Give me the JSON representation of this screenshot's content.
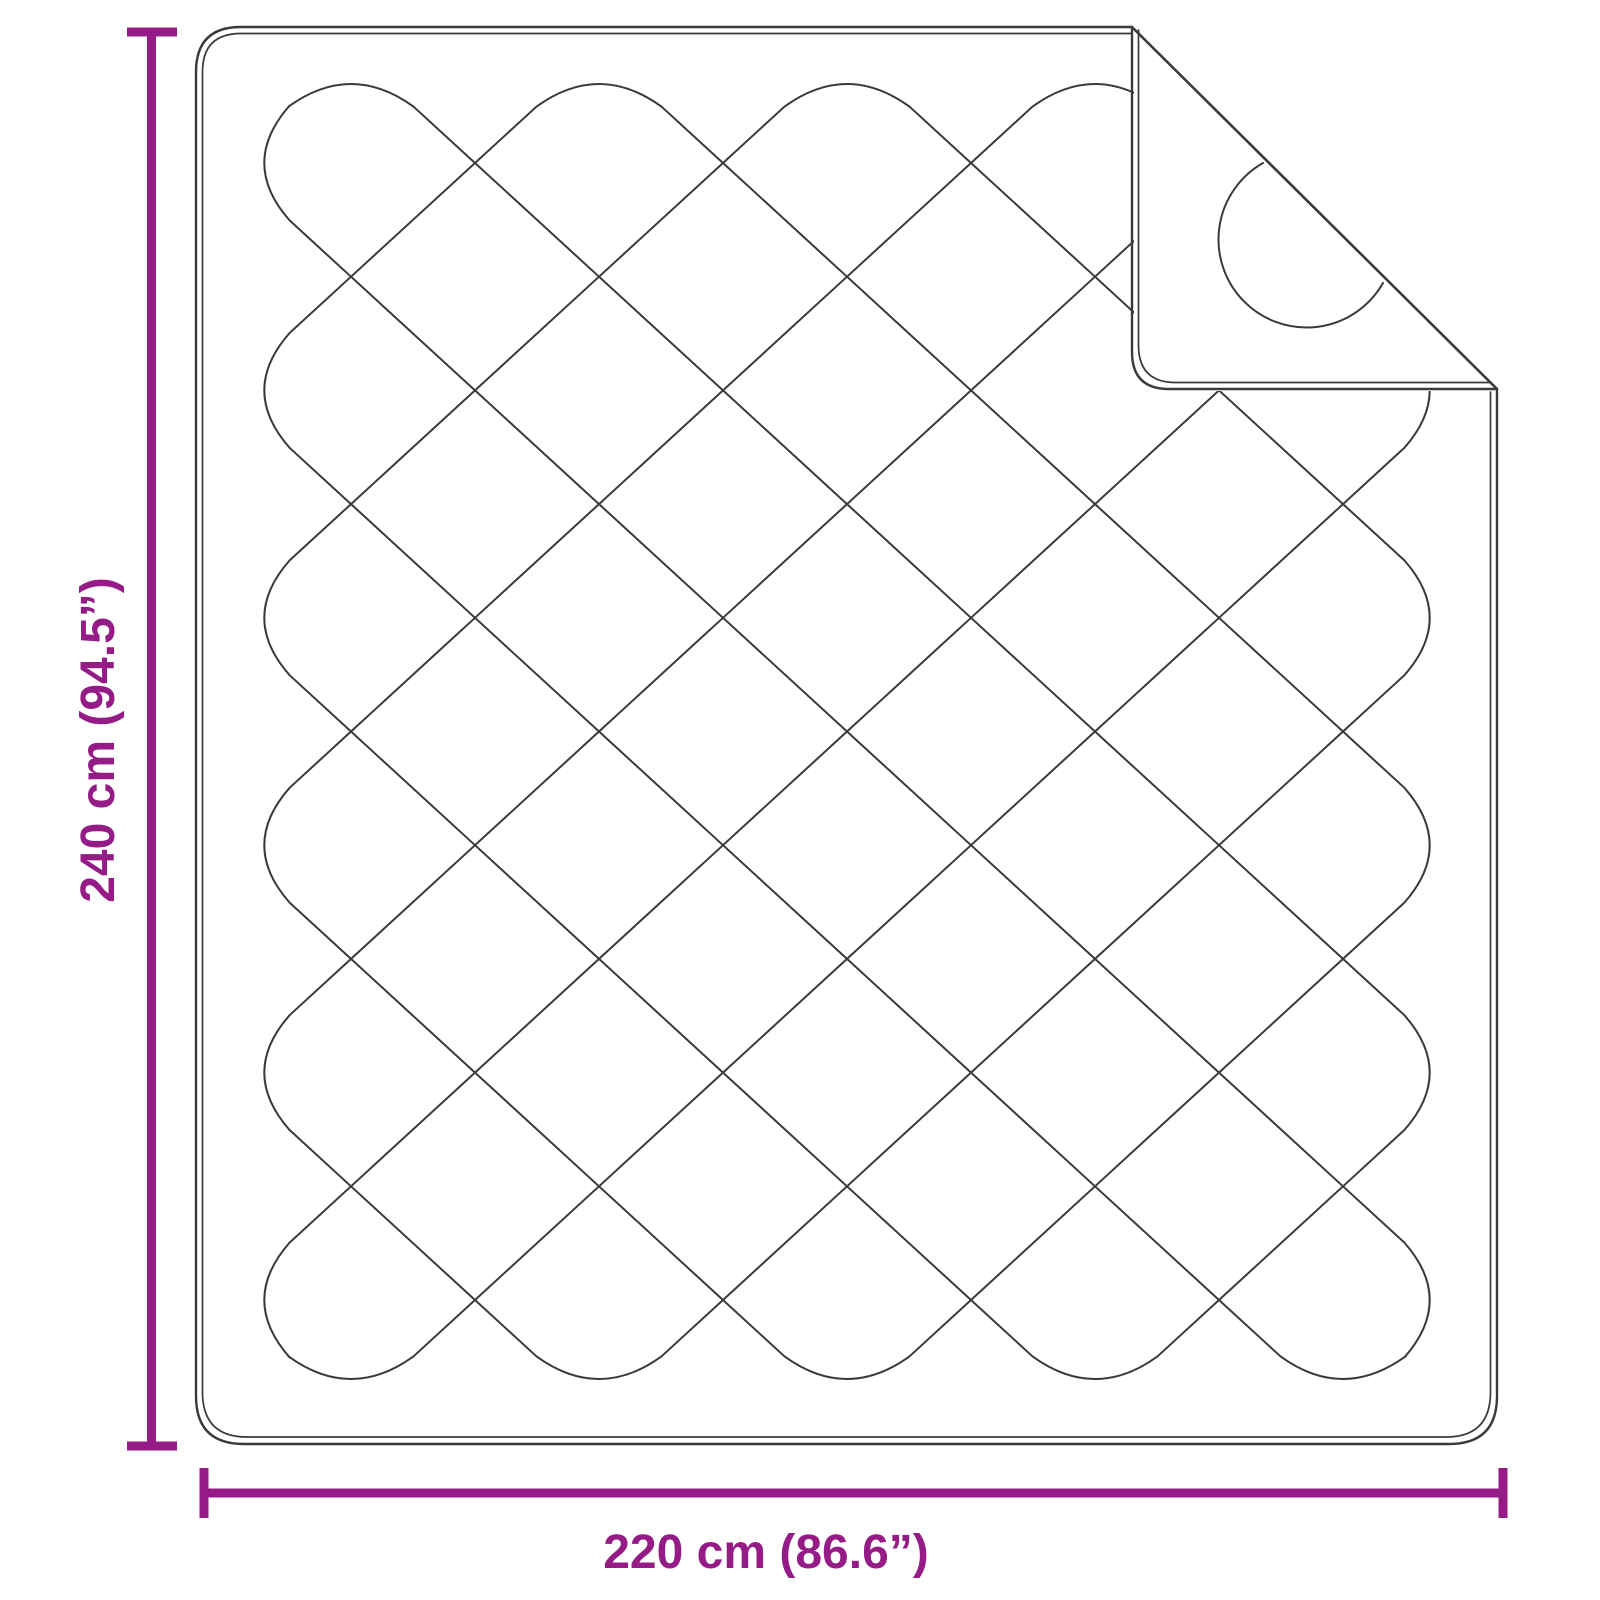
{
  "diagram": {
    "subject": "quilted-blanket-top-view-with-folded-corner",
    "dimensions": {
      "height": {
        "label": "240 cm (94.5”)",
        "value_cm": 240,
        "value_inch": 94.5
      },
      "width": {
        "label": "220 cm (86.6”)",
        "value_cm": 220,
        "value_inch": 86.6
      }
    },
    "colors": {
      "dimension_accent": "#951c87",
      "line_art": "#3a3a3a",
      "background": "#ffffff"
    }
  }
}
